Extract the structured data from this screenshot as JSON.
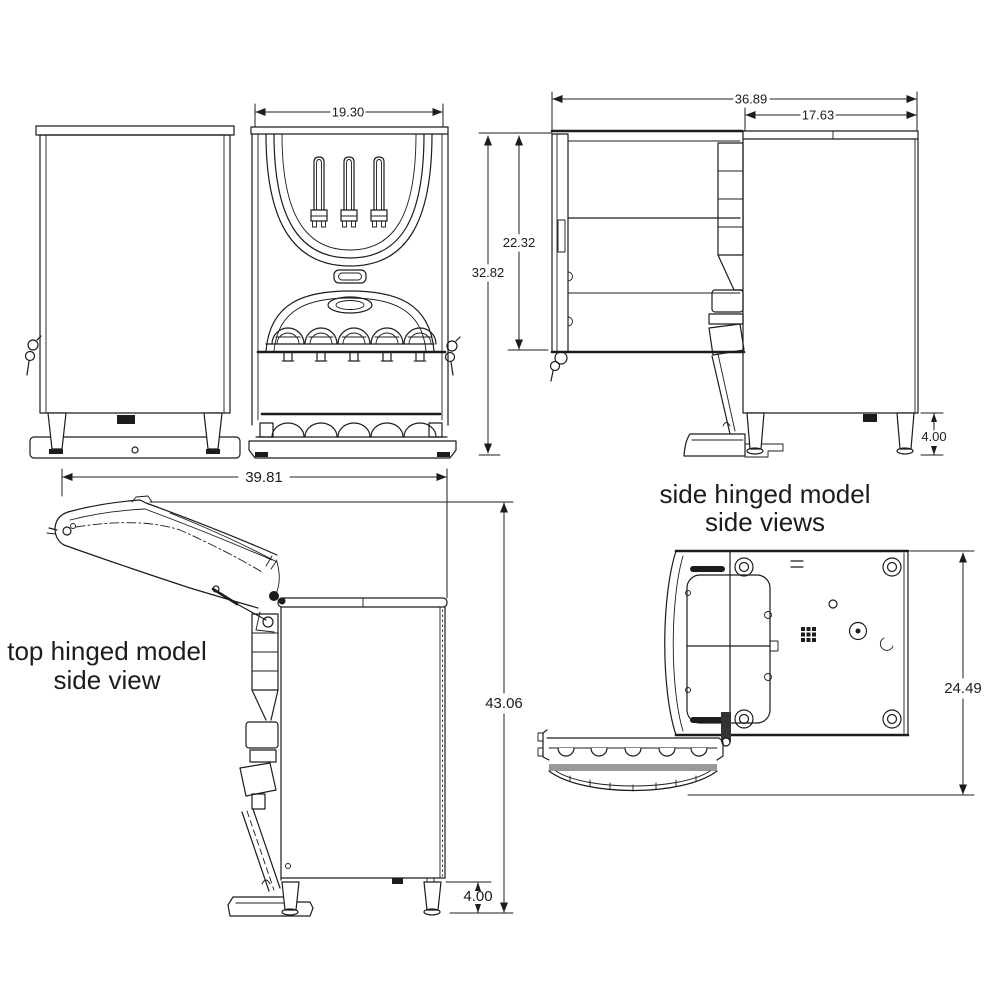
{
  "page": {
    "background": "#ffffff",
    "line_color": "#1c1c1c"
  },
  "views": {
    "rear": {
      "name": "rear view"
    },
    "front": {
      "width_dim": "19.30"
    },
    "side_open": {
      "total_depth_dim": "36.89",
      "cabinet_depth_dim": "17.63",
      "door_length_dim": "22.32",
      "height_dim": "32.82",
      "leg_height_dim": "4.00"
    },
    "top_hinged": {
      "caption_line1": "top hinged model",
      "caption_line2": "side view",
      "open_depth_dim": "39.81",
      "open_height_dim": "43.06",
      "leg_height_dim": "4.00"
    },
    "side_hinged": {
      "caption_line1": "side hinged model",
      "caption_line2": "side views",
      "open_width_dim": "24.49"
    }
  }
}
